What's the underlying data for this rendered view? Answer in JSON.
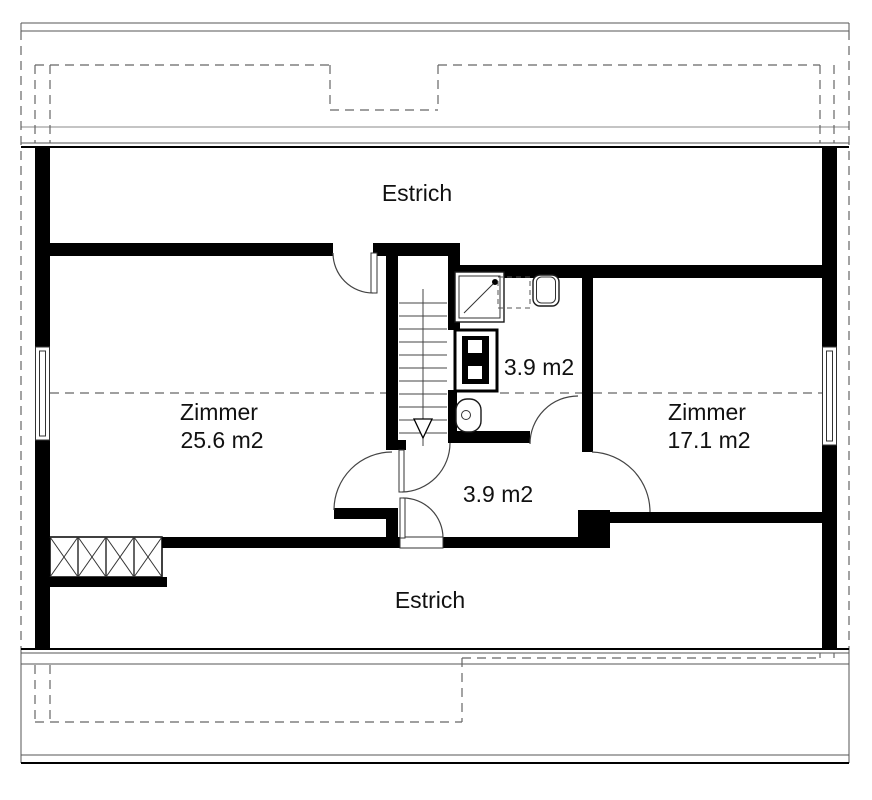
{
  "plan": {
    "type": "attic floor plan",
    "labels": {
      "attic_top": "Estrich",
      "attic_bottom": "Estrich",
      "room_left": {
        "name": "Zimmer",
        "area": "25.6 m2"
      },
      "room_right": {
        "name": "Zimmer",
        "area": "17.1 m2"
      },
      "bathroom_area": "3.9 m2",
      "hallway_area": "3.9 m2"
    },
    "colors": {
      "wall": "#000000",
      "background": "#ffffff",
      "roof_line": "#555555",
      "dashed_line": "#666666",
      "text": "#111111"
    }
  }
}
